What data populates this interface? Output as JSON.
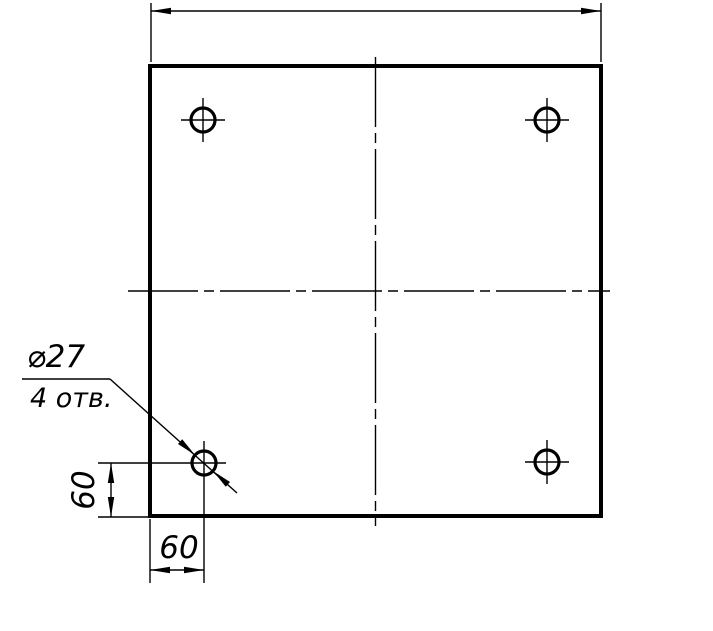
{
  "drawing": {
    "background_color": "#ffffff",
    "line_color": "#000000",
    "callout": {
      "diameter_label": "⌀27",
      "count_label": "4 отв."
    },
    "dimensions": {
      "hole_offset_vertical": "60",
      "hole_offset_horizontal": "60"
    }
  }
}
